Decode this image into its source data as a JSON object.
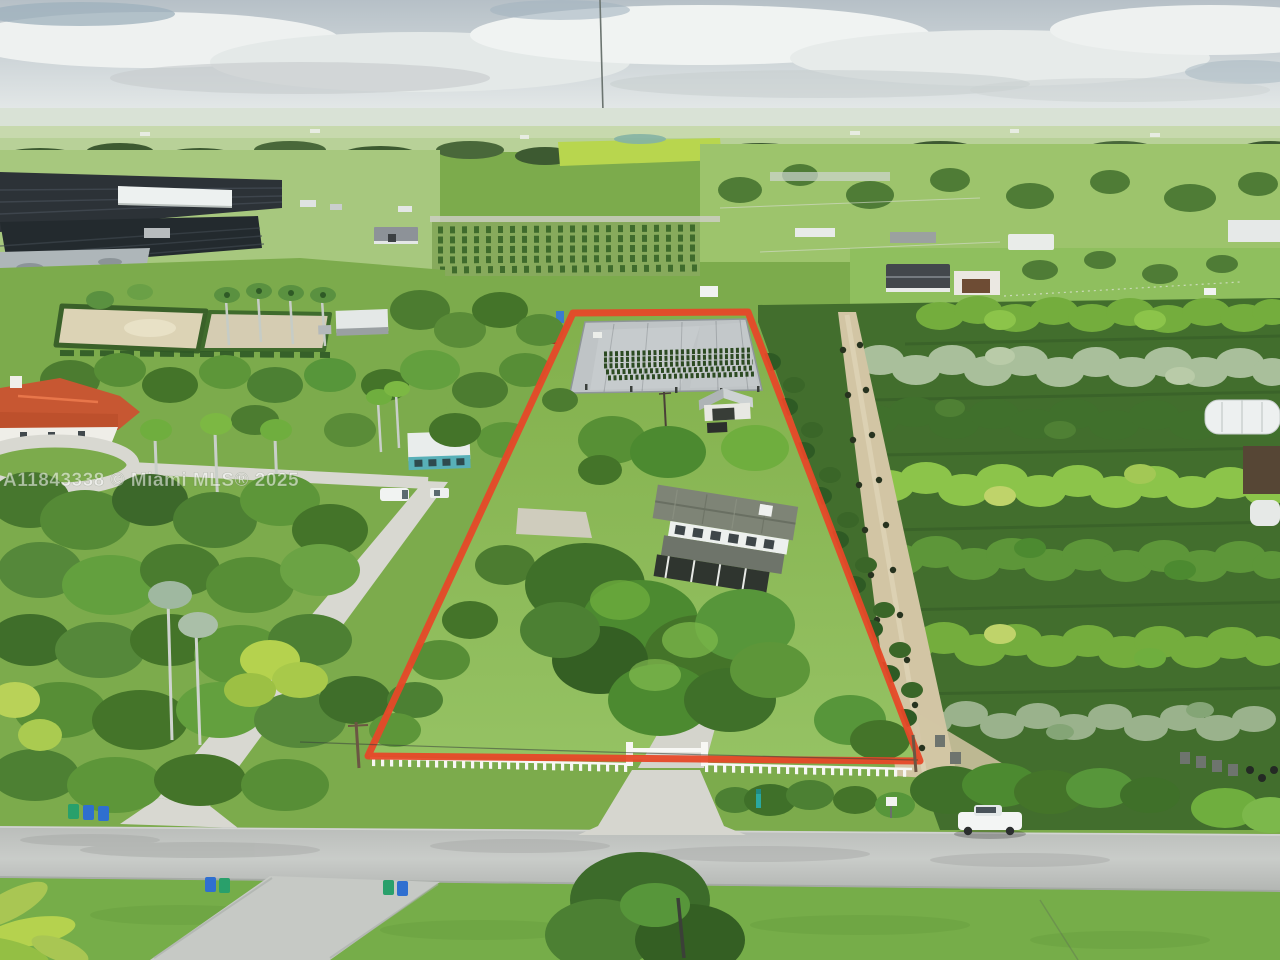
{
  "watermark": {
    "text": "A11843338 © Miami MLS® 2025"
  },
  "colors": {
    "property_outline": "#e64828",
    "sky": "#c9d2d6",
    "lawn": "#85b44f",
    "road": "#c2c5c2",
    "mat_gray": "#bfc4c6",
    "roof_orange": "#c75732",
    "fence_white": "#f7f7f4",
    "truck_white": "#f3f5f4",
    "bin_green": "#29a06b",
    "bin_blue": "#2f6fd0",
    "dirt_path": "#d2c5a4",
    "teal_marker": "#2aa8a0"
  }
}
